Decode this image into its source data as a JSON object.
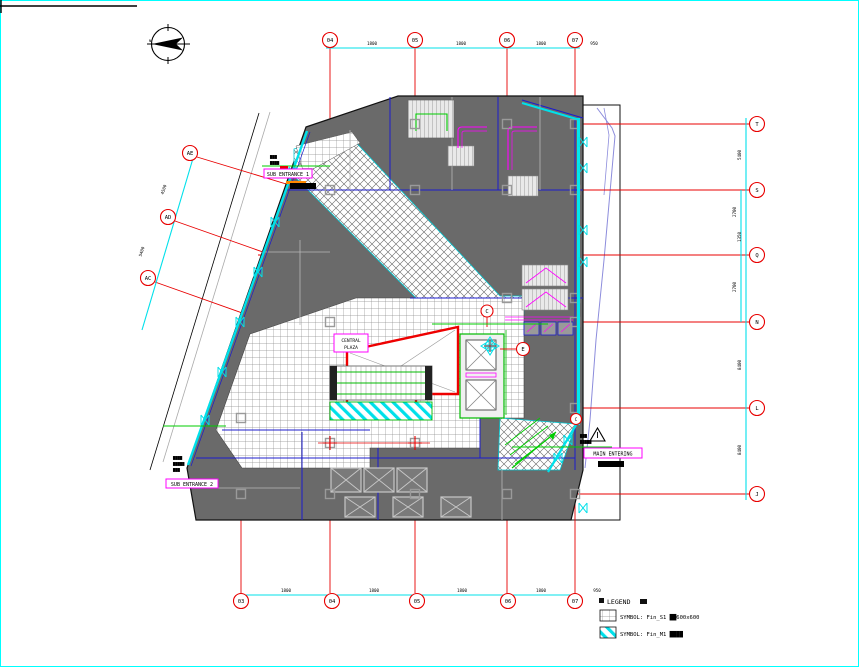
{
  "drawing": {
    "type": "architectural-floor-plan",
    "bg": "#ffffff",
    "border_color": "#00ffff"
  },
  "colors": {
    "grid_red": "#e80000",
    "wall_blue": "#1c1ccc",
    "mass_gray": "#6a6a6a",
    "glazing_cyan": "#00e0ea",
    "escalator_magenta": "#ff00ff",
    "handrail_green": "#00bb00",
    "site_blue": "#8c8cdc"
  },
  "grid": {
    "top": [
      "04",
      "05",
      "06",
      "07"
    ],
    "bottom": [
      "03",
      "04",
      "05",
      "06",
      "07"
    ],
    "right": [
      "T",
      "S",
      "Q",
      "N",
      "L",
      "J"
    ],
    "left": [
      "AE",
      "AD",
      "AC"
    ],
    "dims_top": [
      "1800",
      "1800",
      "1800",
      "950"
    ],
    "dims_bottom": [
      "1800",
      "1800",
      "1800",
      "1800",
      "950"
    ],
    "dims_right": [
      "5400",
      "2700",
      "1350",
      "2700",
      "8400",
      "8400"
    ],
    "dims_left": [
      "4500",
      "5400"
    ]
  },
  "labels": {
    "north": "N",
    "void": "VOID",
    "central_plaza_1": "CENTRAL",
    "central_plaza_2": "PLAZA",
    "sub_entrance_1": "SUB ENTRANCE 1",
    "sub_entrance_2": "SUB ENTRANCE 2",
    "main_entering": "MAIN ENTERING",
    "bubble_c": "C",
    "bubble_e": "E",
    "bubble_c2": "C"
  },
  "notes": {
    "sub1a": "▇▇▇",
    "sub1b": "▇▇▇▇",
    "sub2a": "▇▇▇▇",
    "sub2b": "▇▇▇▇▇",
    "sub2c": "▇▇▇",
    "maina": "▇▇▇",
    "mainb": "▇▇▇▇▇",
    "main_below": "▇▇▇▇"
  },
  "legend": {
    "title": "LEGEND",
    "items": [
      {
        "symbol": "tile-hatch-swatch",
        "text": "SYMBOL: Fin_S1 ██600x600"
      },
      {
        "symbol": "cyan-stripe-swatch",
        "text": "SYMBOL: Fin_M1 ████"
      }
    ]
  }
}
